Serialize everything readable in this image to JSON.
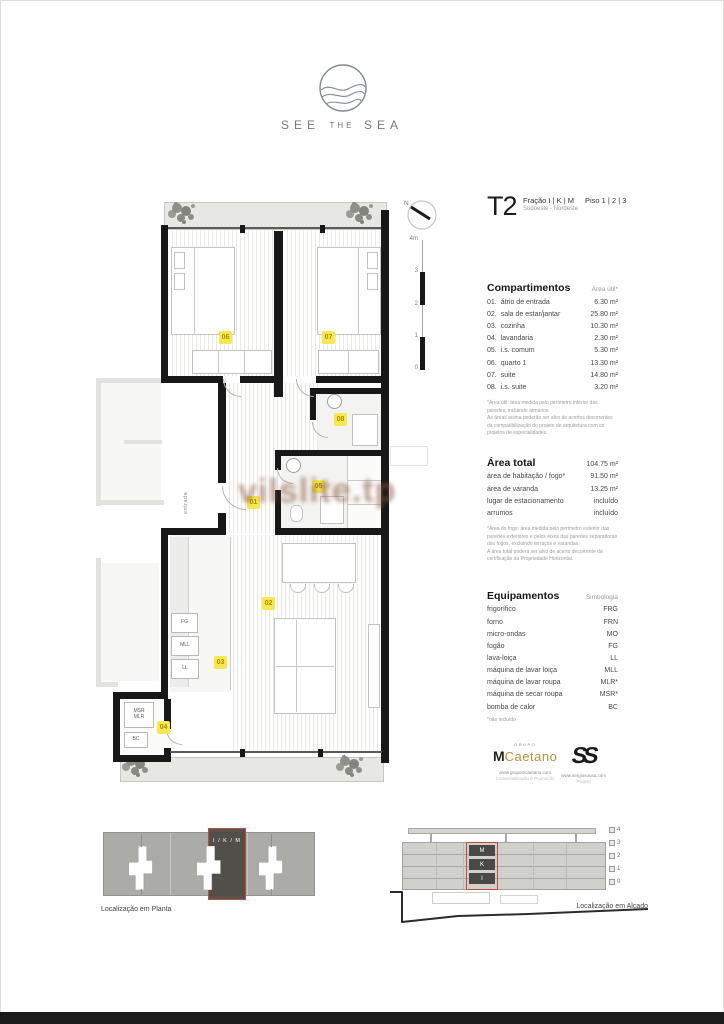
{
  "brand": {
    "p1": "SEE",
    "p2": "THE",
    "p3": "SEA"
  },
  "title": {
    "type": "T2",
    "fraction": "Fração I | K | M",
    "orientation": "Sudoeste - Nordeste",
    "floors": "Piso 1 | 2 | 3"
  },
  "compartments": {
    "heading": "Compartimentos",
    "col": "Área útil*",
    "rows": [
      {
        "num": "01.",
        "name": "átrio de entrada",
        "value": "6.30 m²"
      },
      {
        "num": "02.",
        "name": "sala de estar/jantar",
        "value": "25.80 m²"
      },
      {
        "num": "03.",
        "name": "cozinha",
        "value": "10.30 m²"
      },
      {
        "num": "04.",
        "name": "lavandaria",
        "value": "2.30 m²"
      },
      {
        "num": "05.",
        "name": "i.s. comum",
        "value": "5.30 m²"
      },
      {
        "num": "06.",
        "name": "quarto 1",
        "value": "13.30 m²"
      },
      {
        "num": "07.",
        "name": "suite",
        "value": "14.80 m²"
      },
      {
        "num": "08.",
        "name": "i.s. suite",
        "value": "3.20 m²"
      }
    ],
    "footnote": "*Área útil: área medida pelo perímetro interior das paredes, incluindo armários.\nAs áreas acima poderão ser alvo de acertos decorrentes da compatibilização do projeto de arquitetura com os projetos de especialidades."
  },
  "area_total": {
    "heading": "Área total",
    "value": "104.75 m²",
    "rows": [
      {
        "name": "área de habitação / fogo*",
        "value": "91.50 m²"
      },
      {
        "name": "área de varanda",
        "value": "13.25 m²"
      },
      {
        "name": "lugar de estacionamento",
        "value": "incluído"
      },
      {
        "name": "arrumos",
        "value": "incluído"
      }
    ],
    "footnote": "*Área do fogo: área medida pelo perímetro exterior das paredes exteriores e pelos eixos das paredes separadoras dos fogos, excluindo terraços e varandas.\nA área total poderá ser alvo de acerto decorrente da certificação da Propriedade Horizontal."
  },
  "equipment": {
    "heading": "Equipamentos",
    "col": "Simbologia",
    "rows": [
      {
        "name": "frigorífico",
        "symbol": "FRG"
      },
      {
        "name": "forno",
        "symbol": "FRN"
      },
      {
        "name": "micro-ondas",
        "symbol": "MO"
      },
      {
        "name": "fogão",
        "symbol": "FG"
      },
      {
        "name": "lava-loiça",
        "symbol": "LL"
      },
      {
        "name": "máquina de lavar loiça",
        "symbol": "MLL"
      },
      {
        "name": "máquina de lavar roupa",
        "symbol": "MLR*"
      },
      {
        "name": "máquina de secar roupa",
        "symbol": "MSR*"
      },
      {
        "name": "bomba de calor",
        "symbol": "BC"
      }
    ],
    "footnote": "*não incluído"
  },
  "logos": {
    "mcaetano": {
      "grupo": "GRUPO",
      "m": "M",
      "caetano": "Caetano",
      "url": "www.grupomcaetano.com",
      "role": "Comercialização e Promoção"
    },
    "ss": {
      "mark": "SS",
      "url": "www.sergiosousa.com",
      "role": "Projeto"
    }
  },
  "plan": {
    "watermark": "vilslite.tp",
    "entrance_label": "entrada",
    "north_label": "N",
    "scale_labels": [
      "4m",
      "3",
      "2",
      "1",
      "0"
    ],
    "badges": [
      "06",
      "07",
      "08",
      "05",
      "01",
      "02",
      "03",
      "04"
    ],
    "kitchen_labels": [
      "FG",
      "MLL",
      "LL"
    ],
    "laundry_labels": [
      "MSR",
      "MLR",
      "BC"
    ]
  },
  "locations": {
    "plan_caption": "Localização em Planta",
    "unit_label": "I / K / M",
    "elev_caption": "Localização em Alçado",
    "elev_units": [
      "M",
      "K",
      "I"
    ],
    "elev_floors": [
      "4",
      "3",
      "2",
      "1",
      "0"
    ]
  }
}
